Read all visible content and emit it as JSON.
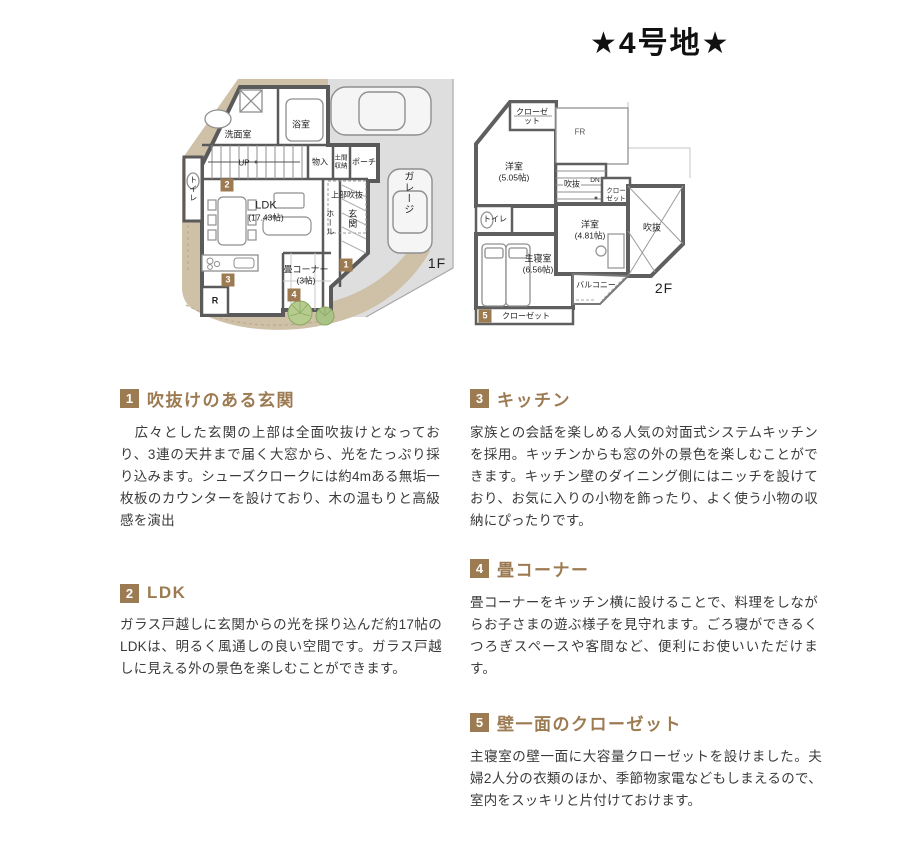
{
  "title": "★4号地★",
  "colors": {
    "accent_brown": "#9d7b52",
    "site_beige": "#cfc0a8",
    "garage_gray": "#dedede",
    "wall_gray": "#5a5a5a",
    "tree_green": "#b5cc8e"
  },
  "plan_markers": {
    "m1": "1",
    "m2": "2",
    "m3": "3",
    "m4": "4",
    "m5": "5"
  },
  "plans": {
    "floor1": {
      "label": "1F",
      "rooms": {
        "washroom": "洗面室",
        "bath": "浴室",
        "toilet": "トイレ",
        "stairs_up": "UP",
        "storage": "物入",
        "doma_storage": "土間収納",
        "porch": "ポーチ",
        "upper_void": "上部吹抜",
        "hall": "ホール",
        "entrance": "玄関",
        "ldk_name": "LDK",
        "ldk_size": "(17.43帖)",
        "tatami_name": "畳コーナー",
        "tatami_size": "(3帖)",
        "garage": "ガレージ",
        "refrigerator": "R"
      }
    },
    "floor2": {
      "label": "2F",
      "rooms": {
        "closet_nw": "クローゼット",
        "free_room": "FR",
        "bedroom_w_name": "洋室",
        "bedroom_w_size": "(5.05帖)",
        "stair_void": "吹抜",
        "stairs_down": "DN",
        "closet_e": "クローゼット",
        "toilet": "トイレ",
        "bedroom_e_name": "洋室",
        "bedroom_e_size": "(4.81帖)",
        "void": "吹抜",
        "master_name": "主寝室",
        "master_size": "(6.56帖)",
        "balcony": "バルコニー",
        "closet_s": "クローゼット"
      }
    }
  },
  "sections": [
    {
      "num": "1",
      "title": "吹抜けのある玄関",
      "body": "　広々とした玄関の上部は全面吹抜けとなっており、3連の天井まで届く大窓から、光をたっぷり採り込みます。シューズクロークには約4mある無垢一枚板のカウンターを設けており、木の温もりと高級感を演出"
    },
    {
      "num": "2",
      "title": "LDK",
      "body": "ガラス戸越しに玄関からの光を採り込んだ約17帖のLDKは、明るく風通しの良い空間です。ガラス戸越しに見える外の景色を楽しむことができます。"
    },
    {
      "num": "3",
      "title": "キッチン",
      "body": "家族との会話を楽しめる人気の対面式システムキッチンを採用。キッチンからも窓の外の景色を楽しむことができます。キッチン壁のダイニング側にはニッチを設けており、お気に入りの小物を飾ったり、よく使う小物の収納にぴったりです。"
    },
    {
      "num": "4",
      "title": "畳コーナー",
      "body": "畳コーナーをキッチン横に設けることで、料理をしながらお子さまの遊ぶ様子を見守れます。ごろ寝ができるくつろぎスペースや客間など、便利にお使いいただけます。"
    },
    {
      "num": "5",
      "title": "壁一面のクローゼット",
      "body": "主寝室の壁一面に大容量クローゼットを設けました。夫婦2人分の衣類のほか、季節物家電などもしまえるので、室内をスッキリと片付けておけます。"
    }
  ]
}
